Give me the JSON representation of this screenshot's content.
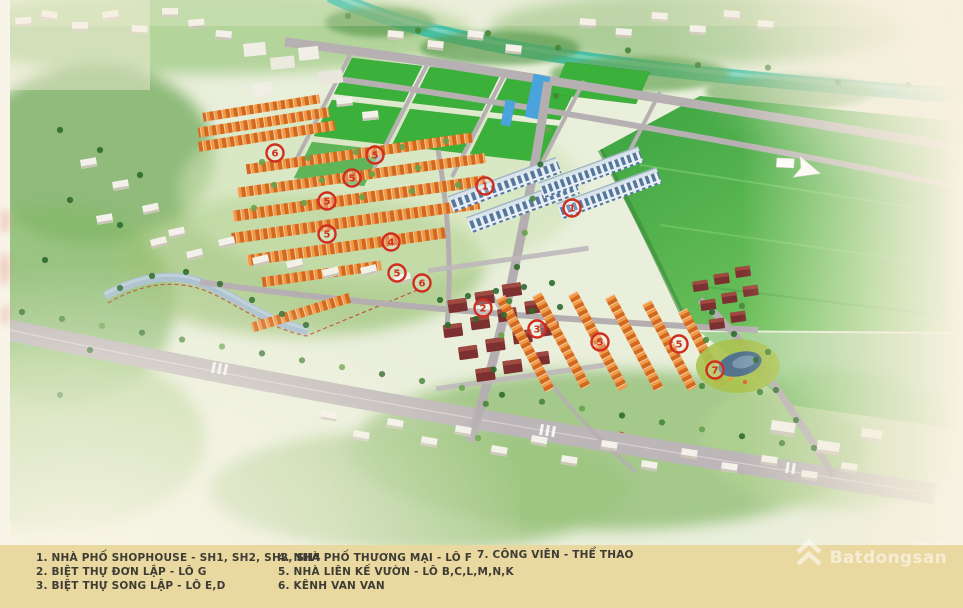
{
  "page": {
    "background": "#f3ecd9"
  },
  "map": {
    "marker_color": "#cf2e20",
    "river_color": "#45c1a8",
    "legend_band_color": "#e9d8a0",
    "markers": [
      {
        "x": 275,
        "y": 153,
        "label": "6"
      },
      {
        "x": 375,
        "y": 155,
        "label": "5"
      },
      {
        "x": 352,
        "y": 178,
        "label": "5"
      },
      {
        "x": 327,
        "y": 201,
        "label": "5"
      },
      {
        "x": 327,
        "y": 234,
        "label": "5"
      },
      {
        "x": 485,
        "y": 186,
        "label": "1"
      },
      {
        "x": 572,
        "y": 208,
        "label": "1"
      },
      {
        "x": 391,
        "y": 242,
        "label": "4"
      },
      {
        "x": 397,
        "y": 273,
        "label": "5"
      },
      {
        "x": 422,
        "y": 283,
        "label": "6"
      },
      {
        "x": 483,
        "y": 308,
        "label": "2"
      },
      {
        "x": 537,
        "y": 329,
        "label": "3"
      },
      {
        "x": 600,
        "y": 342,
        "label": "5"
      },
      {
        "x": 679,
        "y": 344,
        "label": "5"
      },
      {
        "x": 715,
        "y": 370,
        "label": "7"
      }
    ],
    "arrow": {
      "x": 801,
      "y": 168
    }
  },
  "legend": {
    "columns": [
      [
        "1. NHÀ PHỐ SHOPHOUSE - SH1, SH2, SH3, SH4",
        "2. BIỆT THỰ ĐƠN LẬP - LÔ G",
        "3. BIỆT THỰ SONG LẬP - LÔ E,D"
      ],
      [
        "4. NHÀ PHỐ THƯƠNG MẠI - LÔ F",
        "5. NHÀ LIÊN KẾ VƯỜN - LÔ B,C,L,M,N,K",
        "6. KÊNH VAN VAN"
      ],
      [
        "7. CÔNG VIÊN - THỂ THAO"
      ]
    ]
  },
  "watermark": {
    "brand": "Batdongsan",
    "domain": "com.vn"
  }
}
